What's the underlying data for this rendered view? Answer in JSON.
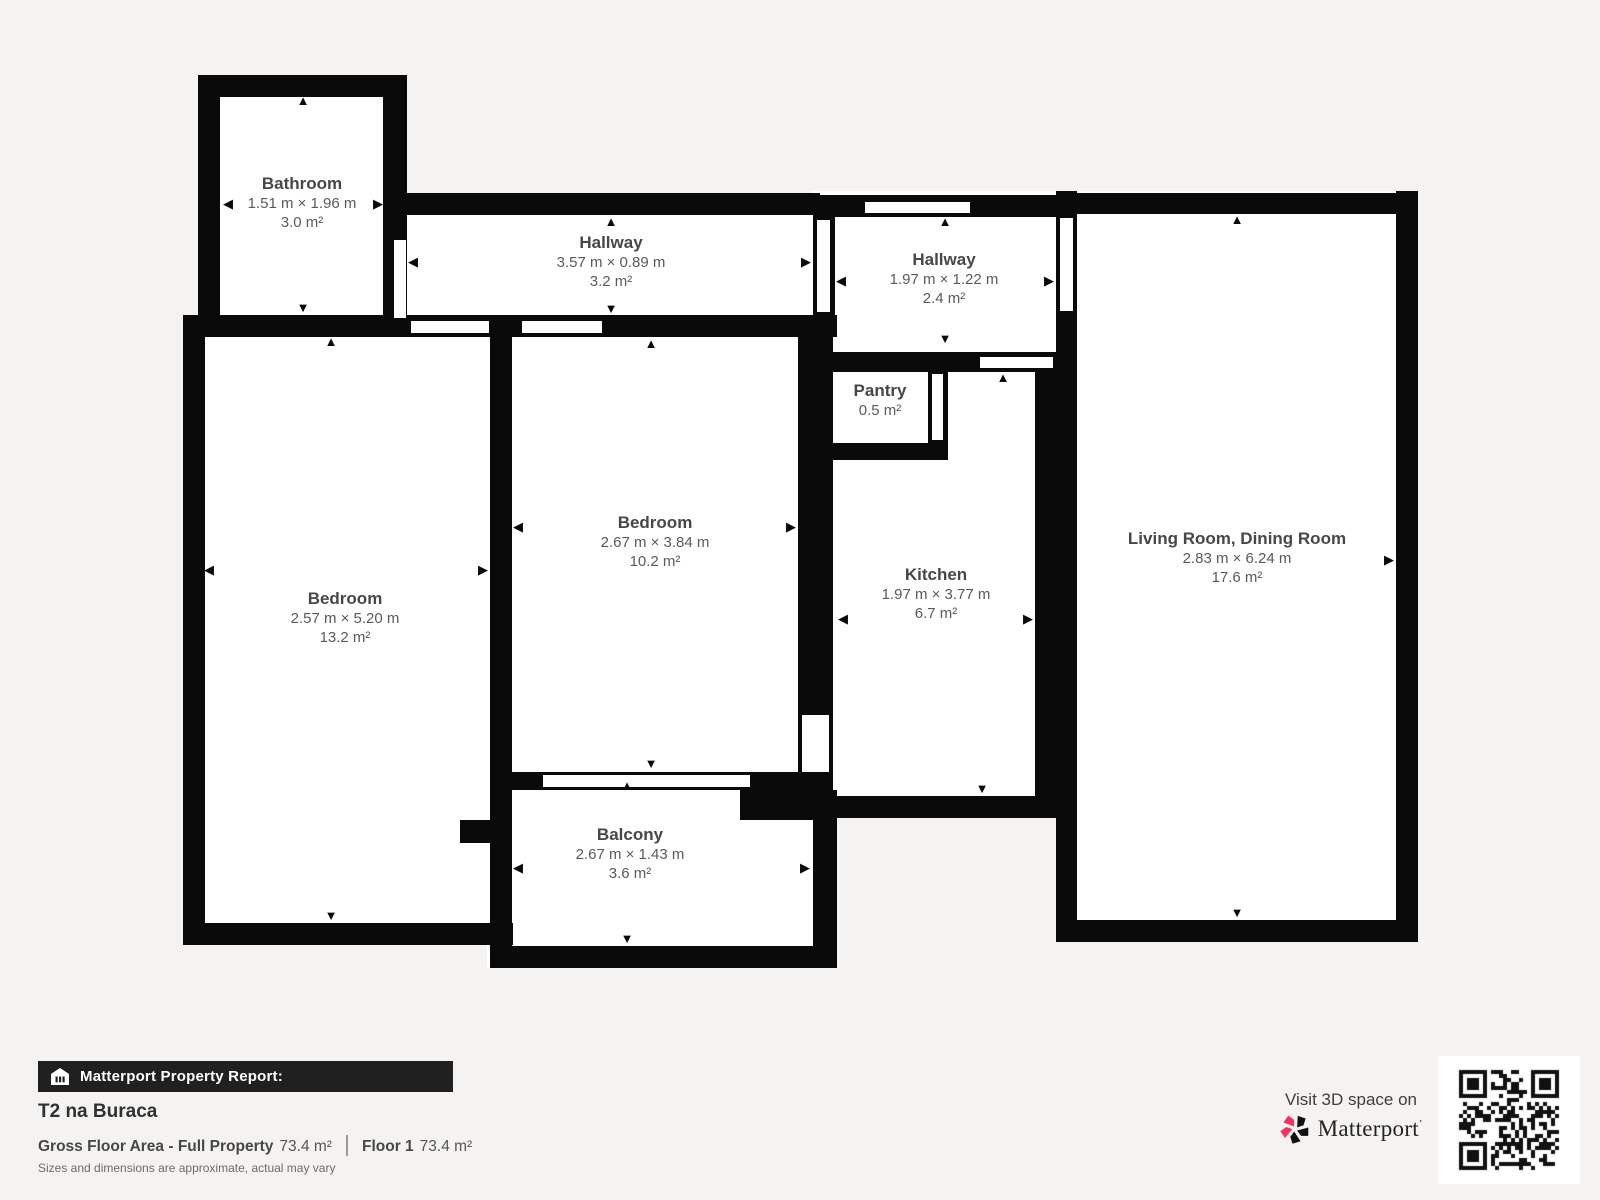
{
  "colors": {
    "background": "#f4f3f1",
    "wall": "#0a0a0a",
    "room_fill": "#ffffff",
    "brand_pink": "#f23360",
    "report_bar_bg": "#202020"
  },
  "floorplan": {
    "rooms": [
      {
        "id": "bathroom",
        "name": "Bathroom",
        "dims": "1.51 m × 1.96 m",
        "area": "3.0 m²",
        "cx": 302,
        "cy": 184
      },
      {
        "id": "hallway-top",
        "name": "Hallway",
        "dims": "3.57 m × 0.89 m",
        "area": "3.2 m²",
        "cx": 611,
        "cy": 243
      },
      {
        "id": "hallway-entry",
        "name": "Hallway",
        "dims": "1.97 m × 1.22 m",
        "area": "2.4 m²",
        "cx": 944,
        "cy": 260
      },
      {
        "id": "pantry",
        "name": "Pantry",
        "dims": "",
        "area": "0.5 m²",
        "cx": 880,
        "cy": 391
      },
      {
        "id": "kitchen",
        "name": "Kitchen",
        "dims": "1.97 m × 3.77 m",
        "area": "6.7 m²",
        "cx": 936,
        "cy": 575
      },
      {
        "id": "bedroom-middle",
        "name": "Bedroom",
        "dims": "2.67 m × 3.84 m",
        "area": "10.2 m²",
        "cx": 655,
        "cy": 523
      },
      {
        "id": "bedroom-left",
        "name": "Bedroom",
        "dims": "2.57 m × 5.20 m",
        "area": "13.2 m²",
        "cx": 345,
        "cy": 599
      },
      {
        "id": "living-dining",
        "name": "Living Room, Dining Room",
        "dims": "2.83 m × 6.24 m",
        "area": "17.6 m²",
        "cx": 1237,
        "cy": 539
      },
      {
        "id": "balcony",
        "name": "Balcony",
        "dims": "2.67 m × 1.43 m",
        "area": "3.6 m²",
        "cx": 630,
        "cy": 835
      }
    ],
    "floors": [
      [
        198,
        75,
        209,
        245
      ],
      [
        385,
        193,
        450,
        144
      ],
      [
        813,
        191,
        264,
        181
      ],
      [
        1056,
        191,
        362,
        751
      ],
      [
        798,
        345,
        258,
        473
      ],
      [
        490,
        315,
        347,
        475
      ],
      [
        183,
        315,
        330,
        630
      ],
      [
        487,
        772,
        350,
        196
      ]
    ],
    "walls": [
      [
        198,
        75,
        207,
        22
      ],
      [
        198,
        75,
        22,
        245
      ],
      [
        383,
        75,
        24,
        262
      ],
      [
        183,
        315,
        654,
        22
      ],
      [
        385,
        193,
        435,
        22
      ],
      [
        813,
        195,
        245,
        22
      ],
      [
        1056,
        193,
        362,
        21
      ],
      [
        813,
        215,
        22,
        122
      ],
      [
        1056,
        191,
        21,
        733
      ],
      [
        1396,
        191,
        22,
        751
      ],
      [
        1056,
        920,
        362,
        22
      ],
      [
        1035,
        372,
        21,
        446
      ],
      [
        813,
        352,
        245,
        20
      ],
      [
        798,
        337,
        35,
        459
      ],
      [
        818,
        443,
        130,
        17
      ],
      [
        928,
        372,
        20,
        71
      ],
      [
        815,
        796,
        241,
        22
      ],
      [
        183,
        315,
        22,
        630
      ],
      [
        183,
        923,
        330,
        22
      ],
      [
        490,
        315,
        22,
        653
      ],
      [
        490,
        946,
        347,
        22
      ],
      [
        813,
        790,
        24,
        178
      ],
      [
        512,
        772,
        286,
        18
      ],
      [
        740,
        790,
        97,
        30
      ],
      [
        460,
        820,
        52,
        23
      ]
    ],
    "doors": [
      [
        394,
        240,
        12,
        78
      ],
      [
        411,
        321,
        78,
        12
      ],
      [
        522,
        321,
        80,
        12
      ],
      [
        817,
        220,
        13,
        92
      ],
      [
        865,
        202,
        105,
        11
      ],
      [
        1060,
        218,
        13,
        93
      ],
      [
        980,
        357,
        73,
        11
      ],
      [
        932,
        374,
        11,
        66
      ],
      [
        802,
        715,
        27,
        57
      ],
      [
        543,
        775,
        207,
        12
      ]
    ],
    "arrows": [
      {
        "dir": "up",
        "x": 303,
        "y": 101
      },
      {
        "dir": "left",
        "x": 228,
        "y": 204
      },
      {
        "dir": "right",
        "x": 378,
        "y": 204
      },
      {
        "dir": "down",
        "x": 303,
        "y": 308
      },
      {
        "dir": "up",
        "x": 611,
        "y": 222
      },
      {
        "dir": "left",
        "x": 413,
        "y": 262
      },
      {
        "dir": "right",
        "x": 806,
        "y": 262
      },
      {
        "dir": "down",
        "x": 611,
        "y": 309
      },
      {
        "dir": "up",
        "x": 945,
        "y": 222
      },
      {
        "dir": "left",
        "x": 841,
        "y": 281
      },
      {
        "dir": "right",
        "x": 1049,
        "y": 281
      },
      {
        "dir": "down",
        "x": 945,
        "y": 339
      },
      {
        "dir": "up",
        "x": 1003,
        "y": 378
      },
      {
        "dir": "left",
        "x": 843,
        "y": 619
      },
      {
        "dir": "right",
        "x": 1028,
        "y": 619
      },
      {
        "dir": "down",
        "x": 982,
        "y": 789
      },
      {
        "dir": "up",
        "x": 651,
        "y": 344
      },
      {
        "dir": "left",
        "x": 518,
        "y": 527
      },
      {
        "dir": "right",
        "x": 791,
        "y": 527
      },
      {
        "dir": "down",
        "x": 651,
        "y": 764
      },
      {
        "dir": "up",
        "x": 331,
        "y": 342
      },
      {
        "dir": "left",
        "x": 209,
        "y": 570
      },
      {
        "dir": "right",
        "x": 483,
        "y": 570
      },
      {
        "dir": "down",
        "x": 331,
        "y": 916
      },
      {
        "dir": "up",
        "x": 1237,
        "y": 220
      },
      {
        "dir": "left",
        "x": 1064,
        "y": 560
      },
      {
        "dir": "right",
        "x": 1389,
        "y": 560
      },
      {
        "dir": "down",
        "x": 1237,
        "y": 913
      },
      {
        "dir": "up",
        "x": 627,
        "y": 786
      },
      {
        "dir": "left",
        "x": 518,
        "y": 868
      },
      {
        "dir": "right",
        "x": 805,
        "y": 868
      },
      {
        "dir": "down",
        "x": 627,
        "y": 939
      }
    ]
  },
  "footer": {
    "report_label": "Matterport Property Report:",
    "title": "T2 na Buraca",
    "gfa_label": "Gross Floor Area - Full Property",
    "gfa_value": "73.4 m²",
    "floor_label": "Floor 1",
    "floor_value": "73.4 m²",
    "disclaimer": "Sizes and dimensions are approximate, actual may vary"
  },
  "cta": {
    "visit_text": "Visit 3D space on",
    "brand": "Matterport"
  }
}
